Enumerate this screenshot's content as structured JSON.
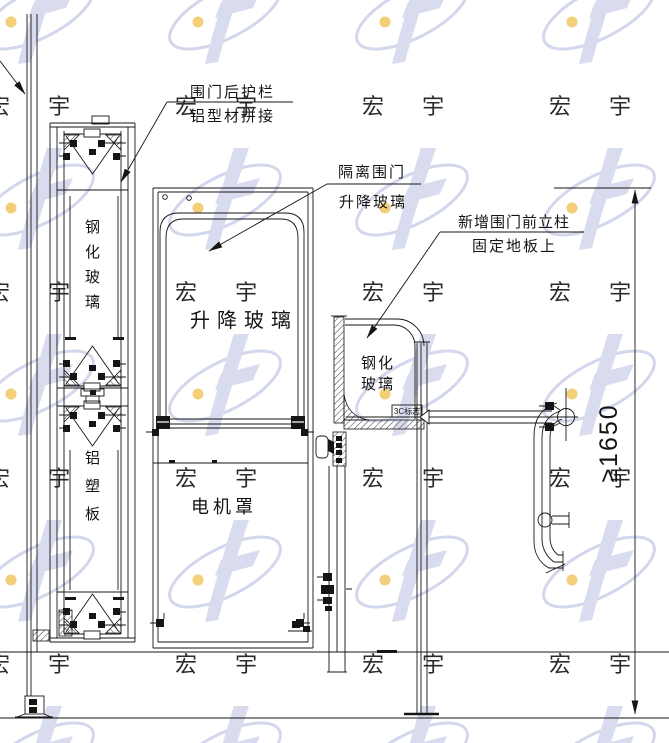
{
  "watermark": {
    "brand": "宏 宇",
    "swoosh_color": "#cfd3ea",
    "glyph_color": "#d5d8ee",
    "dot_color": "#eec04e",
    "text_color": "#c2c7e0"
  },
  "drawing": {
    "line_color": "#151515",
    "callouts": {
      "rear_guard": {
        "line1": "围门后护栏",
        "line2": "铝型材拼接"
      },
      "isolation_door": {
        "line1": "隔离围门",
        "line2": "升降玻璃"
      },
      "new_post": {
        "line1": "新增围门前立柱",
        "line2": "固定地板上"
      }
    },
    "labels": {
      "lifting_glass": "升降玻璃",
      "motor_cover": "电机罩",
      "right_glass": [
        "钢化",
        "玻璃"
      ],
      "left_glass_vertical": [
        "钢",
        "化",
        "玻",
        "璃"
      ],
      "left_panel_vertical": [
        "铝",
        "塑",
        "板"
      ],
      "cert_mark": "3C标志",
      "dimension_height": "≥1650"
    }
  }
}
